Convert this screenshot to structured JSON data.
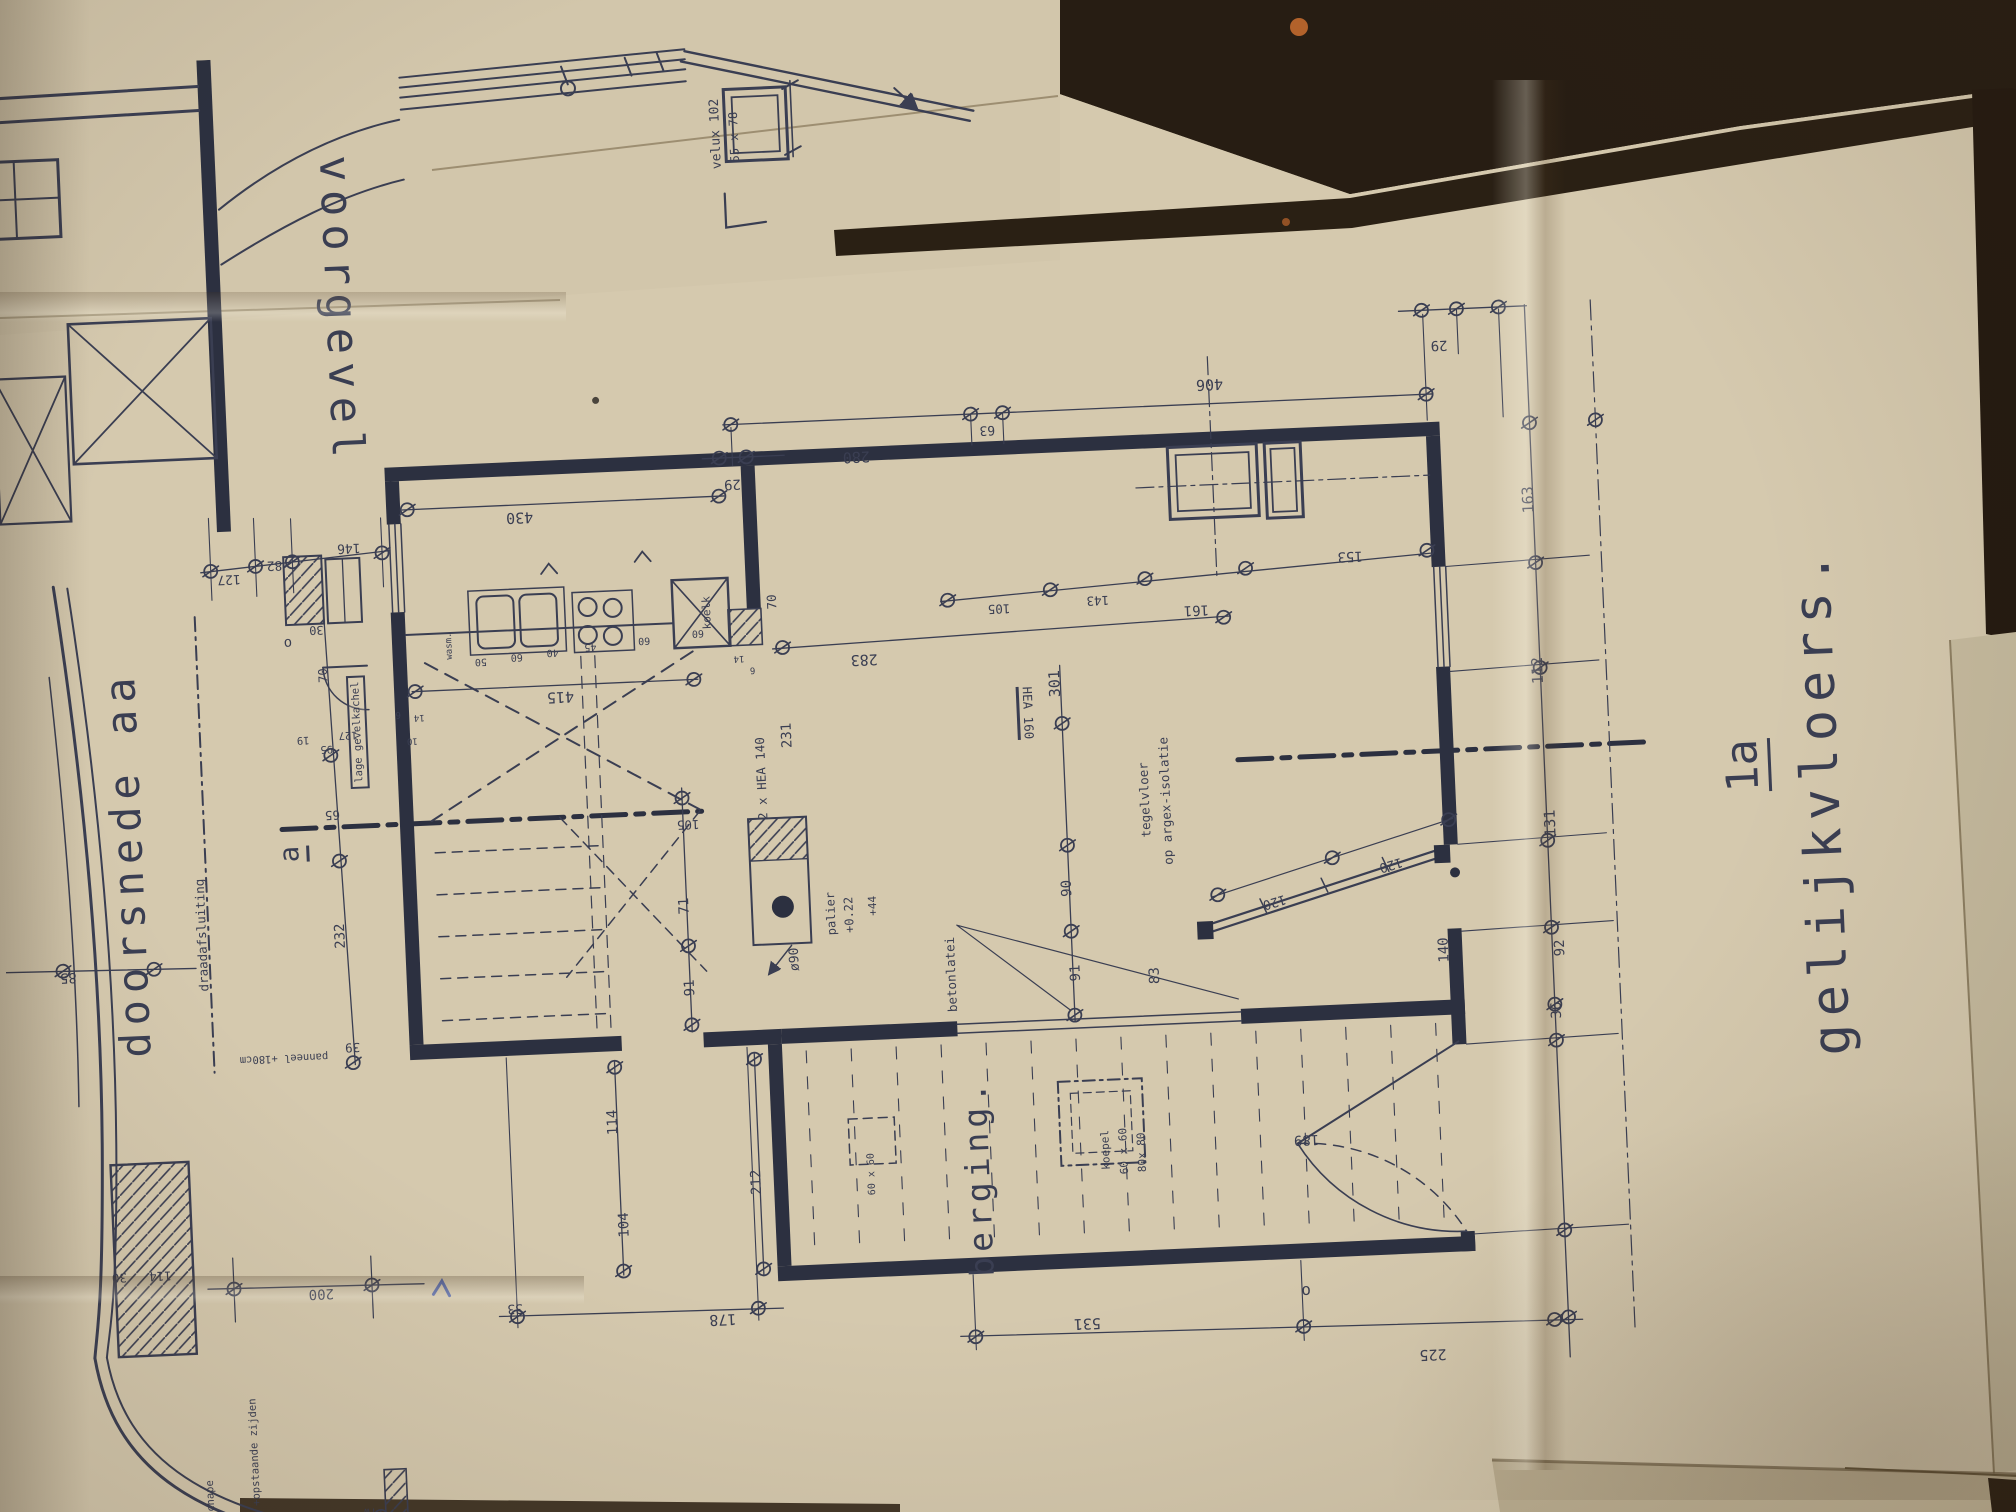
{
  "image_kind": "photograph of a folded architectural blueprint (Dutch floor plan)",
  "colors": {
    "ink": "#3a3e52",
    "ink-strong": "#2c3040",
    "paper": "#d5c9ae",
    "paper-dark": "#c3b698",
    "table": "#2b2117",
    "rust": "#b2622b",
    "pen-blue": "#3f57a8"
  },
  "titles": {
    "front_facade": "voorgevel",
    "section": "doorsnede aa",
    "floor_plan": "gelijkvloers.",
    "sheet_ref": "1a",
    "storage_room": "berging."
  },
  "labels": [
    {
      "n": "title-voorgevel",
      "t": "voorgevel",
      "x": 363,
      "y": 256,
      "r": 90,
      "s": 44,
      "ls": 8
    },
    {
      "n": "title-doorsnede-aa",
      "t": "doorsnede aa",
      "x": 127,
      "y": 800,
      "r": -90,
      "s": 42,
      "ls": 7
    },
    {
      "n": "title-gelijkvloers",
      "t": "gelijkvloers.",
      "x": 1822,
      "y": 810,
      "r": -90,
      "s": 52,
      "ls": 8
    },
    {
      "n": "sheet-ref-1a",
      "t": "1a",
      "x": 1747,
      "y": 772,
      "r": -90,
      "s": 44,
      "u": 1
    },
    {
      "n": "title-berging",
      "t": "berging.",
      "x": 963,
      "y": 1150,
      "r": -90,
      "s": 33,
      "ls": 5
    },
    {
      "n": "section-marker-a",
      "t": "a",
      "x": 292,
      "y": 797,
      "r": -90,
      "s": 27,
      "u": 1
    },
    {
      "n": "marker-o-left",
      "t": "o",
      "x": 296,
      "y": 586,
      "r": 0,
      "s": 14
    },
    {
      "n": "marker-o-bottom",
      "t": "o",
      "x": 1285,
      "y": 1277,
      "r": 0,
      "s": 16
    },
    {
      "n": "ann-velux",
      "t": "velux 102",
      "x": 746,
      "y": 96,
      "r": -90,
      "s": 13
    },
    {
      "n": "ann-velux-size",
      "t": "55 x 78",
      "x": 764,
      "y": 100,
      "r": -90,
      "s": 12
    },
    {
      "n": "ann-draadafsluiting",
      "t": "draadafsluiting",
      "x": 197,
      "y": 874,
      "r": -90,
      "s": 12.5
    },
    {
      "n": "ann-lage-gevelkachel",
      "t": "lage gevelkachel",
      "x": 362,
      "y": 678,
      "r": -90,
      "s": 10.5,
      "box": 1
    },
    {
      "n": "ann-wasmachine",
      "t": "wasm.",
      "x": 458,
      "y": 596,
      "r": -90,
      "s": 9
    },
    {
      "n": "ann-koelkast",
      "t": "koelk",
      "x": 716,
      "y": 574,
      "r": -90,
      "s": 11
    },
    {
      "n": "ann-palier",
      "t": "palier",
      "x": 827,
      "y": 880,
      "r": -90,
      "s": 12
    },
    {
      "n": "ann-palier-niveau",
      "t": "+0.22",
      "x": 845,
      "y": 882,
      "r": -90,
      "s": 12
    },
    {
      "n": "ann-niveau-44",
      "t": "+44",
      "x": 869,
      "y": 874,
      "r": -90,
      "s": 11
    },
    {
      "n": "ann-diameter-90",
      "t": "ø90",
      "x": 789,
      "y": 924,
      "r": -90,
      "s": 13
    },
    {
      "n": "ann-beam-hea140",
      "t": "2 x HEA 140",
      "x": 763,
      "y": 742,
      "r": -90,
      "s": 12.5
    },
    {
      "n": "ann-beam-hea160",
      "t": "HEA 160",
      "x": 1030,
      "y": 688,
      "r": 90,
      "s": 12.5,
      "u": 1
    },
    {
      "n": "ann-betonlatei",
      "t": "betonlatei",
      "x": 944,
      "y": 946,
      "r": -90,
      "s": 12.5
    },
    {
      "n": "ann-tegelvloer",
      "t": "tegelvloer",
      "x": 1145,
      "y": 780,
      "r": -90,
      "s": 12.5
    },
    {
      "n": "ann-argex-isolatie",
      "t": "op argex-isolatie",
      "x": 1166,
      "y": 782,
      "r": -90,
      "s": 12.5
    },
    {
      "n": "ann-koepel",
      "t": "koepel",
      "x": 1091,
      "y": 1128,
      "r": -90,
      "s": 11
    },
    {
      "n": "ann-koepel-6060",
      "t": "60 x 60",
      "x": 1109,
      "y": 1130,
      "r": -90,
      "s": 11
    },
    {
      "n": "ann-koepel-8080",
      "t": "80x 80",
      "x": 1127,
      "y": 1132,
      "r": -90,
      "s": 11
    },
    {
      "n": "ann-skylight-6060",
      "t": "60 x 60",
      "x": 857,
      "y": 1142,
      "r": -90,
      "s": 10
    },
    {
      "n": "ann-panneel-180",
      "t": "panneel +180cm",
      "x": 274,
      "y": 1000,
      "r": 180,
      "s": 10.5
    },
    {
      "n": "ann-vloer-chape",
      "t": "vloer + chape",
      "x": 182,
      "y": 1460,
      "r": -90,
      "s": 10.5
    },
    {
      "n": "ann-20cm",
      "t": "20 cm",
      "x": 203,
      "y": 1488,
      "r": -90,
      "s": 10.5
    },
    {
      "n": "ann-opstaande-zijden",
      "t": "0,2 mm +opstaande zijden",
      "x": 228,
      "y": 1415,
      "r": -90,
      "s": 10.5
    },
    {
      "n": "ann-regenwater",
      "t": "rw",
      "x": 340,
      "y": 1456,
      "r": 180,
      "s": 10
    },
    {
      "n": "dim-430",
      "t": "430",
      "x": 533,
      "y": 470,
      "r": 180,
      "s": 15
    },
    {
      "n": "dim-29-a",
      "t": "29",
      "x": 747,
      "y": 446,
      "r": 180,
      "s": 14
    },
    {
      "n": "dim-280",
      "t": "280",
      "x": 872,
      "y": 424,
      "r": 180,
      "s": 15
    },
    {
      "n": "dim-63",
      "t": "63",
      "x": 1004,
      "y": 403,
      "r": 180,
      "s": 13
    },
    {
      "n": "dim-406",
      "t": "406",
      "x": 1228,
      "y": 367,
      "r": 180,
      "s": 15
    },
    {
      "n": "dim-29-b",
      "t": "29",
      "x": 1459,
      "y": 338,
      "r": 180,
      "s": 14
    },
    {
      "n": "dim-163",
      "t": "163",
      "x": 1542,
      "y": 497,
      "r": -90,
      "s": 15
    },
    {
      "n": "dim-112",
      "t": "112",
      "x": 1544,
      "y": 668,
      "r": -90,
      "s": 15
    },
    {
      "n": "dim-131",
      "t": "131",
      "x": 1550,
      "y": 821,
      "r": -90,
      "s": 15
    },
    {
      "n": "dim-92",
      "t": "92",
      "x": 1554,
      "y": 946,
      "r": -90,
      "s": 14
    },
    {
      "n": "dim-36",
      "t": "36",
      "x": 1548,
      "y": 1008,
      "r": -90,
      "s": 14
    },
    {
      "n": "dim-225",
      "t": "225",
      "x": 1409,
      "y": 1346,
      "r": 180,
      "s": 15
    },
    {
      "n": "dim-531",
      "t": "531",
      "x": 1065,
      "y": 1300,
      "r": 180,
      "s": 15
    },
    {
      "n": "dim-178",
      "t": "178",
      "x": 701,
      "y": 1280,
      "r": 180,
      "s": 15
    },
    {
      "n": "dim-33",
      "t": "33",
      "x": 494,
      "y": 1260,
      "r": 180,
      "s": 13
    },
    {
      "n": "dim-200",
      "t": "200",
      "x": 301,
      "y": 1237,
      "r": 180,
      "s": 14
    },
    {
      "n": "dim-250",
      "t": "250",
      "x": 58,
      "y": 1469,
      "r": 180,
      "s": 14
    },
    {
      "n": "dim-30-section",
      "t": "30",
      "x": 100,
      "y": 1213,
      "r": 180,
      "s": 12.5
    },
    {
      "n": "dim-114-section",
      "t": "114",
      "x": 141,
      "y": 1213,
      "r": 180,
      "s": 12.5
    },
    {
      "n": "dim-85",
      "t": "85",
      "x": 62,
      "y": 910,
      "r": 180,
      "s": 14
    },
    {
      "n": "dim-127-a",
      "t": "127",
      "x": 240,
      "y": 519,
      "r": 180,
      "s": 13
    },
    {
      "n": "dim-82",
      "t": "82",
      "x": 286,
      "y": 507,
      "r": 180,
      "s": 13
    },
    {
      "n": "dim-146",
      "t": "146",
      "x": 361,
      "y": 493,
      "r": 180,
      "s": 13
    },
    {
      "n": "dim-30-b",
      "t": "30",
      "x": 325,
      "y": 574,
      "r": 180,
      "s": 12
    },
    {
      "n": "dim-70-a",
      "t": "70",
      "x": 330,
      "y": 620,
      "r": -90,
      "s": 12
    },
    {
      "n": "dim-19",
      "t": "19",
      "x": 307,
      "y": 683,
      "r": 180,
      "s": 10.5
    },
    {
      "n": "dim-95",
      "t": "95",
      "x": 330,
      "y": 693,
      "r": 180,
      "s": 10.5
    },
    {
      "n": "dim-127-b",
      "t": "127",
      "x": 352,
      "y": 680,
      "r": 180,
      "s": 10.5
    },
    {
      "n": "dim-65",
      "t": "65",
      "x": 333,
      "y": 760,
      "r": 180,
      "s": 12.5
    },
    {
      "n": "dim-232",
      "t": "232",
      "x": 336,
      "y": 881,
      "r": -90,
      "s": 14
    },
    {
      "n": "dim-39",
      "t": "39",
      "x": 343,
      "y": 993,
      "r": 180,
      "s": 12.5
    },
    {
      "n": "dim-50",
      "t": "50",
      "x": 488,
      "y": 612,
      "r": 180,
      "s": 10
    },
    {
      "n": "dim-60-a",
      "t": "60",
      "x": 524,
      "y": 609,
      "r": 180,
      "s": 10
    },
    {
      "n": "dim-40",
      "t": "40",
      "x": 560,
      "y": 606,
      "r": 180,
      "s": 10
    },
    {
      "n": "dim-45",
      "t": "45",
      "x": 598,
      "y": 602,
      "r": 180,
      "s": 10
    },
    {
      "n": "dim-60-b",
      "t": "60",
      "x": 652,
      "y": 598,
      "r": 180,
      "s": 10
    },
    {
      "n": "dim-60-c",
      "t": "60",
      "x": 706,
      "y": 593,
      "r": 180,
      "s": 10
    },
    {
      "n": "dim-70-b",
      "t": "70",
      "x": 781,
      "y": 566,
      "r": -90,
      "s": 12.5
    },
    {
      "n": "dim-14-a",
      "t": "14",
      "x": 746,
      "y": 620,
      "r": 180,
      "s": 9
    },
    {
      "n": "dim-6-a",
      "t": "6",
      "x": 759,
      "y": 632,
      "r": 180,
      "s": 9
    },
    {
      "n": "dim-10",
      "t": "10",
      "x": 416,
      "y": 688,
      "r": 180,
      "s": 9
    },
    {
      "n": "dim-14-b",
      "t": "14",
      "x": 424,
      "y": 665,
      "r": 180,
      "s": 9
    },
    {
      "n": "dim-6-b",
      "t": "6",
      "x": 403,
      "y": 661,
      "r": 180,
      "s": 9
    },
    {
      "n": "dim-415",
      "t": "415",
      "x": 566,
      "y": 651,
      "r": 180,
      "s": 15
    },
    {
      "n": "dim-283",
      "t": "283",
      "x": 871,
      "y": 627,
      "r": 180,
      "s": 15
    },
    {
      "n": "dim-105-a",
      "t": "105",
      "x": 1008,
      "y": 583,
      "r": 180,
      "s": 12.5
    },
    {
      "n": "dim-143",
      "t": "143",
      "x": 1107,
      "y": 579,
      "r": 180,
      "s": 12.5
    },
    {
      "n": "dim-161",
      "t": "161",
      "x": 1205,
      "y": 592,
      "r": 180,
      "s": 14
    },
    {
      "n": "dim-153",
      "t": "153",
      "x": 1361,
      "y": 545,
      "r": 180,
      "s": 14
    },
    {
      "n": "dim-301",
      "t": "301",
      "x": 1061,
      "y": 660,
      "r": -90,
      "s": 15
    },
    {
      "n": "dim-231",
      "t": "231",
      "x": 791,
      "y": 700,
      "r": -90,
      "s": 14
    },
    {
      "n": "dim-105-b",
      "t": "105",
      "x": 688,
      "y": 785,
      "r": 180,
      "s": 12.5
    },
    {
      "n": "dim-71",
      "t": "71",
      "x": 681,
      "y": 866,
      "r": -90,
      "s": 14
    },
    {
      "n": "dim-91-a",
      "t": "91",
      "x": 683,
      "y": 948,
      "r": -90,
      "s": 14
    },
    {
      "n": "dim-90",
      "t": "90",
      "x": 1064,
      "y": 865,
      "r": -90,
      "s": 14
    },
    {
      "n": "dim-91-b",
      "t": "91",
      "x": 1069,
      "y": 950,
      "r": -90,
      "s": 14
    },
    {
      "n": "dim-83",
      "t": "83",
      "x": 1148,
      "y": 956,
      "r": -90,
      "s": 14
    },
    {
      "n": "dim-120-a",
      "t": "120",
      "x": 1270,
      "y": 887,
      "r": 166,
      "s": 13
    },
    {
      "n": "dim-120-b",
      "t": "120",
      "x": 1388,
      "y": 855,
      "r": 166,
      "s": 13
    },
    {
      "n": "dim-140",
      "t": "140",
      "x": 1438,
      "y": 943,
      "r": -90,
      "s": 14
    },
    {
      "n": "dim-189",
      "t": "189",
      "x": 1292,
      "y": 1126,
      "r": 180,
      "s": 14
    },
    {
      "n": "dim-212",
      "t": "212",
      "x": 741,
      "y": 1145,
      "r": -90,
      "s": 14
    },
    {
      "n": "dim-104",
      "t": "104",
      "x": 607,
      "y": 1182,
      "r": -90,
      "s": 14
    },
    {
      "n": "dim-114-b",
      "t": "114",
      "x": 600,
      "y": 1079,
      "r": -90,
      "s": 14
    }
  ]
}
